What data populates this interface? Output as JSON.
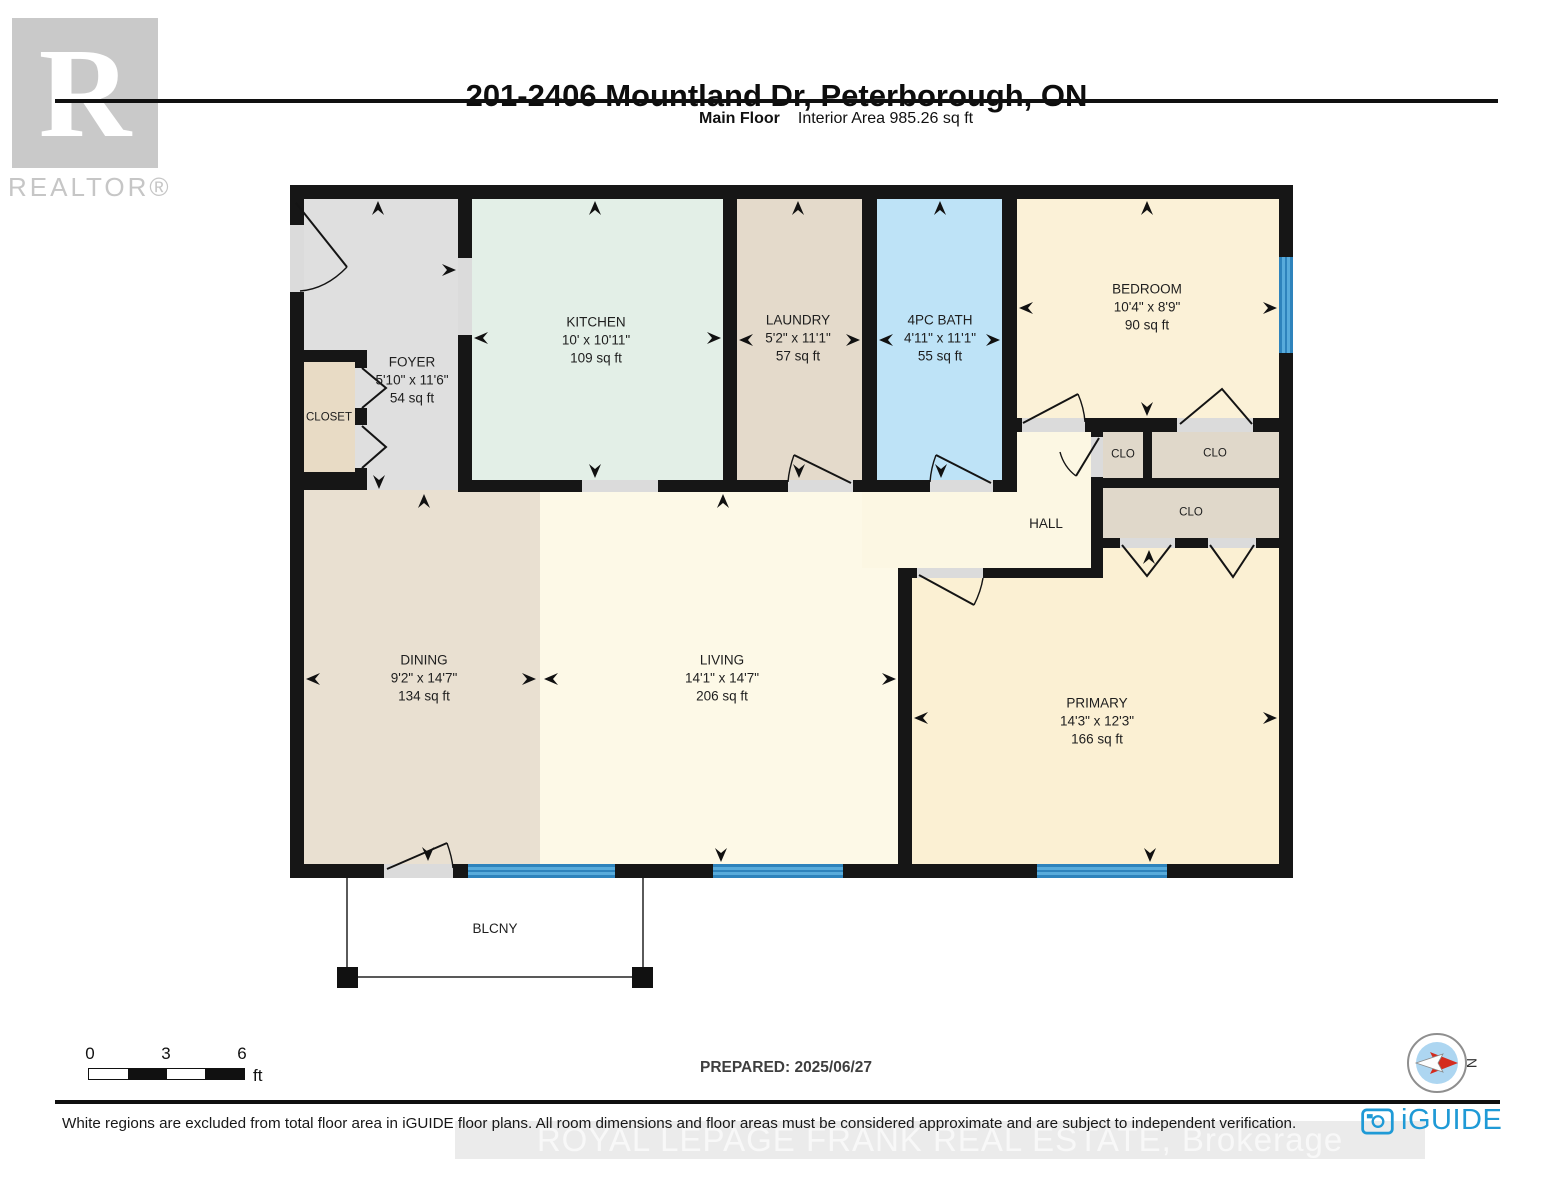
{
  "header": {
    "title": "201-2406 Mountland Dr, Peterborough, ON",
    "floor_label": "Main Floor",
    "interior_area_label": "Interior Area 985.26 sq ft"
  },
  "branding": {
    "realtor_letter": "R",
    "realtor_wordmark": "REALTOR®",
    "iguide_wordmark": "iGUIDE",
    "watermark": "ROYAL LEPAGE FRANK REAL ESTATE, Brokerage"
  },
  "rooms": {
    "foyer": {
      "name": "FOYER",
      "dims": "5'10\" x 11'6\"",
      "area": "54 sq ft"
    },
    "closet": {
      "name": "CLOSET"
    },
    "kitchen": {
      "name": "KITCHEN",
      "dims": "10' x 10'11\"",
      "area": "109 sq ft"
    },
    "laundry": {
      "name": "LAUNDRY",
      "dims": "5'2\" x 11'1\"",
      "area": "57 sq ft"
    },
    "bath": {
      "name": "4PC BATH",
      "dims": "4'11\" x 11'1\"",
      "area": "55 sq ft"
    },
    "bedroom": {
      "name": "BEDROOM",
      "dims": "10'4\" x 8'9\"",
      "area": "90 sq ft"
    },
    "clo_small": {
      "name": "CLO"
    },
    "clo_top": {
      "name": "CLO"
    },
    "clo_bottom": {
      "name": "CLO"
    },
    "hall": {
      "name": "HALL"
    },
    "dining": {
      "name": "DINING",
      "dims": "9'2\" x 14'7\"",
      "area": "134 sq ft"
    },
    "living": {
      "name": "LIVING",
      "dims": "14'1\" x 14'7\"",
      "area": "206 sq ft"
    },
    "primary": {
      "name": "PRIMARY",
      "dims": "14'3\" x 12'3\"",
      "area": "166 sq ft"
    },
    "balcony": {
      "name": "BLCNY"
    }
  },
  "scale_bar": {
    "tick_0": "0",
    "tick_3": "3",
    "tick_6": "6",
    "unit": "ft"
  },
  "prepared_label": "PREPARED: 2025/06/27",
  "compass": {
    "north_label": "N"
  },
  "footer": {
    "disclaimer": "White regions are excluded from total floor area in iGUIDE floor plans. All room dimensions and floor areas must be considered approximate and are subject to independent verification."
  },
  "colors": {
    "wall": "#161616",
    "window_blue": "#58ABDB",
    "window_line": "#2E83BC",
    "bath_blue": "#BEE3F7",
    "kitchen_green": "#E3EFE7",
    "iguide_blue": "#1F9AD6",
    "compass_red": "#D42B1E"
  }
}
